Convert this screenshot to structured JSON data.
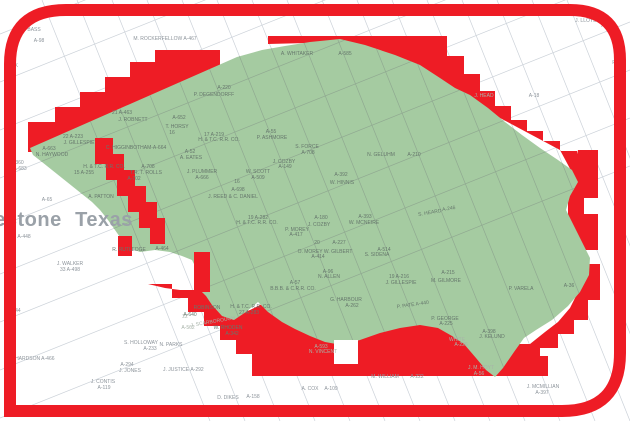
{
  "map": {
    "type": "county-survey-parcel-map",
    "colors": {
      "highlight_red": "#ee1c25",
      "selected_region_green": "#a5cba1",
      "parcel_line_white_area": "#ccd2d9",
      "parcel_line_green_area": "#90a991",
      "label_gray": "#8d949b",
      "label_green_area": "#66776c",
      "county_label_gray": "#9aa1a8",
      "background": "#ffffff"
    },
    "county_labels": [
      {
        "t": "estone",
        "x": 28,
        "y": 226,
        "c": "county"
      },
      {
        "t": "Texas",
        "x": 104,
        "y": 226,
        "c": "county"
      }
    ],
    "labels": [
      {
        "t": "A. BASS",
        "x": 31,
        "y": 31,
        "c": "w"
      },
      {
        "t": "A-98",
        "x": 39,
        "y": 42,
        "c": "w"
      },
      {
        "t": "M. ROCKERFELLOW  A-467",
        "x": 165,
        "y": 40,
        "c": "w"
      },
      {
        "t": "RICK",
        "x": 12,
        "y": 67,
        "c": "w"
      },
      {
        "t": "J. LLOYD",
        "x": 586,
        "y": 22,
        "c": "w"
      },
      {
        "t": "A-327",
        "x": 608,
        "y": 27,
        "c": "w"
      },
      {
        "t": "A-18",
        "x": 534,
        "y": 97,
        "c": "w"
      },
      {
        "t": "R",
        "x": 614,
        "y": 64,
        "c": "w"
      },
      {
        "t": "A-360",
        "x": 17,
        "y": 164,
        "c": "w"
      },
      {
        "t": "A-683",
        "x": 20,
        "y": 170,
        "c": "w"
      },
      {
        "t": "A-65",
        "x": 47,
        "y": 201,
        "c": "w"
      },
      {
        "t": "A-448",
        "x": 24,
        "y": 238,
        "c": "w"
      },
      {
        "t": "A-544",
        "x": 14,
        "y": 312,
        "c": "w"
      },
      {
        "t": "J. WALKER",
        "x": 70,
        "y": 265,
        "c": "w"
      },
      {
        "t": "33  A-498",
        "x": 70,
        "y": 271,
        "c": "w"
      },
      {
        "t": "CHARDSON  A-466",
        "x": 33,
        "y": 360,
        "c": "w"
      },
      {
        "t": "S. HOLLOWAY",
        "x": 141,
        "y": 344,
        "c": "w"
      },
      {
        "t": "A-233",
        "x": 150,
        "y": 350,
        "c": "w"
      },
      {
        "t": "N. PARKS",
        "x": 171,
        "y": 346,
        "c": "w"
      },
      {
        "t": "A-294",
        "x": 127,
        "y": 366,
        "c": "w"
      },
      {
        "t": "J. JONES",
        "x": 130,
        "y": 372,
        "c": "w"
      },
      {
        "t": "J. CONTIS",
        "x": 103,
        "y": 383,
        "c": "w"
      },
      {
        "t": "A-119",
        "x": 104,
        "y": 389,
        "c": "w"
      },
      {
        "t": "J. JUSTICE",
        "x": 176,
        "y": 371,
        "c": "w"
      },
      {
        "t": "A-292",
        "x": 197,
        "y": 371,
        "c": "w"
      },
      {
        "t": "D. DIKES",
        "x": 228,
        "y": 399,
        "c": "w"
      },
      {
        "t": "A-158",
        "x": 253,
        "y": 398,
        "c": "w"
      },
      {
        "t": "A. COX",
        "x": 310,
        "y": 390,
        "c": "w"
      },
      {
        "t": "A-109",
        "x": 331,
        "y": 390,
        "c": "w"
      },
      {
        "t": "M. WILLIAM",
        "x": 385,
        "y": 378,
        "c": "w"
      },
      {
        "t": "A-222",
        "x": 417,
        "y": 378,
        "c": "w"
      },
      {
        "t": "J. MCMILLIAN",
        "x": 543,
        "y": 388,
        "c": "w"
      },
      {
        "t": "A-397",
        "x": 542,
        "y": 394,
        "c": "w"
      },
      {
        "t": "J. HEAD",
        "x": 484,
        "y": 97,
        "c": "r"
      },
      {
        "t": "22",
        "x": 185,
        "y": 318,
        "c": "r"
      },
      {
        "t": "J. SCARBOROUGH",
        "x": 213,
        "y": 323,
        "c": "r",
        "r": -10
      },
      {
        "t": "A-562",
        "x": 188,
        "y": 329,
        "c": "r"
      },
      {
        "t": "A-593",
        "x": 321,
        "y": 348,
        "c": "r"
      },
      {
        "t": "N. VINCENT",
        "x": 323,
        "y": 353,
        "c": "r"
      },
      {
        "t": "J. M. HOYT",
        "x": 481,
        "y": 369,
        "c": "r"
      },
      {
        "t": "A-56",
        "x": 479,
        "y": 375,
        "c": "r"
      },
      {
        "t": "WHITE",
        "x": 457,
        "y": 341,
        "c": "r"
      },
      {
        "t": "A-226",
        "x": 461,
        "y": 346,
        "c": "r"
      },
      {
        "t": "A. WHITAKER",
        "x": 297,
        "y": 55,
        "c": "g"
      },
      {
        "t": "A-585",
        "x": 345,
        "y": 55,
        "c": "g"
      },
      {
        "t": "A-220",
        "x": 224,
        "y": 89,
        "c": "g"
      },
      {
        "t": "P. DEGENDORFF",
        "x": 214,
        "y": 96,
        "c": "g"
      },
      {
        "t": "21   A-463",
        "x": 122,
        "y": 114,
        "c": "g"
      },
      {
        "t": "J. ROBNETT",
        "x": 133,
        "y": 121,
        "c": "g"
      },
      {
        "t": "22   A-223",
        "x": 73,
        "y": 138,
        "c": "g"
      },
      {
        "t": "J. GILLESPIE",
        "x": 79,
        "y": 144,
        "c": "g"
      },
      {
        "t": "C. HIGGINBOTHAM-A-664",
        "x": 136,
        "y": 149,
        "c": "g"
      },
      {
        "t": "A-652",
        "x": 179,
        "y": 119,
        "c": "g"
      },
      {
        "t": "T. HORSY",
        "x": 177,
        "y": 128,
        "c": "g"
      },
      {
        "t": "16",
        "x": 172,
        "y": 134,
        "c": "g"
      },
      {
        "t": "17   A-219",
        "x": 214,
        "y": 136,
        "c": "g"
      },
      {
        "t": "H. & T.C. R.R. CO.",
        "x": 219,
        "y": 141,
        "c": "g"
      },
      {
        "t": "A-52",
        "x": 190,
        "y": 153,
        "c": "g"
      },
      {
        "t": "A. EATES",
        "x": 191,
        "y": 159,
        "c": "g"
      },
      {
        "t": "H. & T.C. R.R. CO.",
        "x": 104,
        "y": 168,
        "c": "g"
      },
      {
        "t": "15    A-255",
        "x": 84,
        "y": 174,
        "c": "g"
      },
      {
        "t": "A-708",
        "x": 148,
        "y": 168,
        "c": "g"
      },
      {
        "t": "T.R. T. ROLLS",
        "x": 146,
        "y": 174,
        "c": "g"
      },
      {
        "t": "A-702",
        "x": 134,
        "y": 180,
        "c": "g"
      },
      {
        "t": "J. PLUMMER",
        "x": 202,
        "y": 173,
        "c": "g"
      },
      {
        "t": "A-666",
        "x": 202,
        "y": 179,
        "c": "g"
      },
      {
        "t": "A-663",
        "x": 49,
        "y": 150,
        "c": "g"
      },
      {
        "t": "N. HAYWOOD",
        "x": 52,
        "y": 156,
        "c": "g"
      },
      {
        "t": "A. PATTON",
        "x": 101,
        "y": 198,
        "c": "g"
      },
      {
        "t": "W. SCOTT",
        "x": 258,
        "y": 173,
        "c": "g"
      },
      {
        "t": "A-509",
        "x": 258,
        "y": 179,
        "c": "g"
      },
      {
        "t": "J. COZBY",
        "x": 284,
        "y": 163,
        "c": "g"
      },
      {
        "t": "A-149",
        "x": 285,
        "y": 168,
        "c": "g"
      },
      {
        "t": "16",
        "x": 237,
        "y": 183,
        "c": "g"
      },
      {
        "t": "A-698",
        "x": 238,
        "y": 191,
        "c": "g"
      },
      {
        "t": "J. REED & C. DANIEL",
        "x": 233,
        "y": 198,
        "c": "g"
      },
      {
        "t": "S. FORCE",
        "x": 307,
        "y": 148,
        "c": "g"
      },
      {
        "t": "A-708",
        "x": 308,
        "y": 154,
        "c": "g"
      },
      {
        "t": "A-55",
        "x": 271,
        "y": 133,
        "c": "g"
      },
      {
        "t": "P. ASHMORE",
        "x": 272,
        "y": 139,
        "c": "g"
      },
      {
        "t": "N. GELUHM",
        "x": 381,
        "y": 156,
        "c": "g"
      },
      {
        "t": "A-210",
        "x": 414,
        "y": 156,
        "c": "g"
      },
      {
        "t": "A-392",
        "x": 341,
        "y": 176,
        "c": "g"
      },
      {
        "t": "W. HINNIS",
        "x": 342,
        "y": 184,
        "c": "g"
      },
      {
        "t": "S. HEARD",
        "x": 430,
        "y": 214,
        "c": "g",
        "r": -10
      },
      {
        "t": "A-246",
        "x": 449,
        "y": 210,
        "c": "g",
        "r": -10
      },
      {
        "t": "A-393",
        "x": 365,
        "y": 218,
        "c": "g"
      },
      {
        "t": "W. MCNEIRE",
        "x": 364,
        "y": 224,
        "c": "g"
      },
      {
        "t": "A-180",
        "x": 321,
        "y": 219,
        "c": "g"
      },
      {
        "t": "J. COZBY",
        "x": 319,
        "y": 226,
        "c": "g"
      },
      {
        "t": "19   A-282",
        "x": 258,
        "y": 219,
        "c": "g"
      },
      {
        "t": "H. & T.C. R.R. CO.",
        "x": 257,
        "y": 224,
        "c": "g"
      },
      {
        "t": "P. MOREY",
        "x": 297,
        "y": 231,
        "c": "g"
      },
      {
        "t": "A-417",
        "x": 296,
        "y": 236,
        "c": "g"
      },
      {
        "t": "20",
        "x": 317,
        "y": 244,
        "c": "g"
      },
      {
        "t": "A-227",
        "x": 339,
        "y": 244,
        "c": "g"
      },
      {
        "t": "O. MOREY W. GILBERT",
        "x": 325,
        "y": 253,
        "c": "g"
      },
      {
        "t": "A-414",
        "x": 318,
        "y": 258,
        "c": "g"
      },
      {
        "t": "A-96",
        "x": 328,
        "y": 273,
        "c": "g"
      },
      {
        "t": "N. ALLEN",
        "x": 329,
        "y": 278,
        "c": "g"
      },
      {
        "t": "A-57",
        "x": 295,
        "y": 284,
        "c": "g"
      },
      {
        "t": "B.B.B. & C.R.R. CO.",
        "x": 293,
        "y": 290,
        "c": "g"
      },
      {
        "t": "A-514",
        "x": 384,
        "y": 251,
        "c": "g"
      },
      {
        "t": "S. SIDENA",
        "x": 377,
        "y": 256,
        "c": "g"
      },
      {
        "t": "19   A-216",
        "x": 399,
        "y": 278,
        "c": "g"
      },
      {
        "t": "J. GILLESPIE",
        "x": 401,
        "y": 284,
        "c": "g"
      },
      {
        "t": "A-215",
        "x": 448,
        "y": 274,
        "c": "g"
      },
      {
        "t": "M. GILMORE",
        "x": 446,
        "y": 282,
        "c": "g"
      },
      {
        "t": "G. HARBOUR",
        "x": 346,
        "y": 301,
        "c": "g"
      },
      {
        "t": "A-262",
        "x": 352,
        "y": 307,
        "c": "g"
      },
      {
        "t": "P. PATE  A-440",
        "x": 413,
        "y": 306,
        "c": "g",
        "r": -8
      },
      {
        "t": "P. GEORGE",
        "x": 445,
        "y": 320,
        "c": "g"
      },
      {
        "t": "A-225",
        "x": 446,
        "y": 325,
        "c": "g"
      },
      {
        "t": "A-398",
        "x": 489,
        "y": 333,
        "c": "g"
      },
      {
        "t": "J. KELUND",
        "x": 492,
        "y": 338,
        "c": "g"
      },
      {
        "t": "P. VARELA",
        "x": 521,
        "y": 290,
        "c": "g"
      },
      {
        "t": "A-36",
        "x": 569,
        "y": 287,
        "c": "g"
      },
      {
        "t": "R. RUTLEDGE",
        "x": 129,
        "y": 251,
        "c": "g"
      },
      {
        "t": "A-464",
        "x": 162,
        "y": 250,
        "c": "g"
      },
      {
        "t": "ROBINSON",
        "x": 207,
        "y": 309,
        "c": "g"
      },
      {
        "t": "A-640",
        "x": 190,
        "y": 316,
        "c": "g"
      },
      {
        "t": "H. & T.C. R.R. CO.",
        "x": 251,
        "y": 308,
        "c": "g"
      },
      {
        "t": "27   A-283",
        "x": 249,
        "y": 314,
        "c": "g"
      },
      {
        "t": "W. RHODEN",
        "x": 228,
        "y": 329,
        "c": "g"
      },
      {
        "t": "A-342",
        "x": 232,
        "y": 335,
        "c": "g"
      }
    ]
  }
}
